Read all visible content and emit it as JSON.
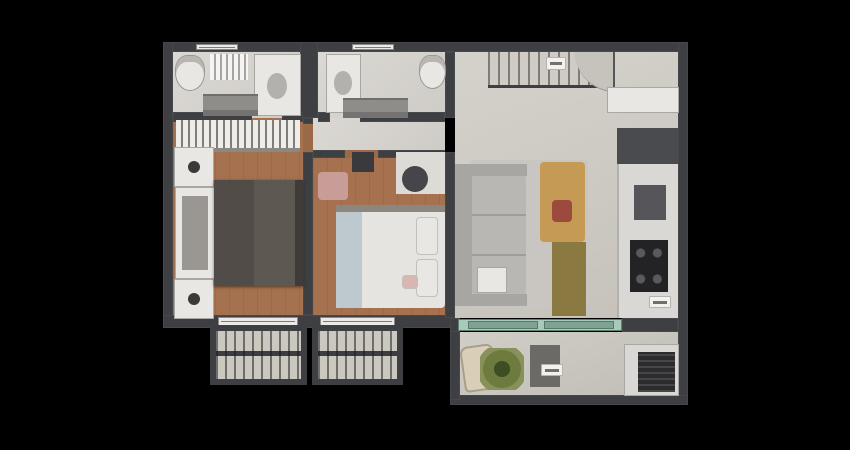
{
  "canvas": {
    "width": 850,
    "height": 450,
    "background": "#000000"
  },
  "plan": {
    "type": "apartment-floor-plan-3d-top-down-render",
    "offset_x": 163,
    "offset_y": 42,
    "width": 525,
    "height": 363,
    "legible_text": [],
    "label_chips": [
      {
        "location": "entry-hall",
        "text": ""
      },
      {
        "location": "kitchen-counter",
        "text": ""
      },
      {
        "location": "balcony",
        "text": ""
      }
    ]
  },
  "palette": {
    "background": "#000000",
    "wall": "#3e3f43",
    "wall_light": "#55565a",
    "wood": "#a5714f",
    "wood_patch": "#9a6948",
    "tile": "#d7d4cf",
    "living_floor": "#d0ccc5",
    "balcony_floor": "#cbc8c0",
    "glass": "#a8cabb",
    "glass_panel": "#7fa392",
    "white": "#e9e7e3",
    "counter": "#dad8d4",
    "shower": "#8f8d8a",
    "wardrobe_base": "#b0ada8",
    "headboard_inner": "#9a9792",
    "bed_dark": "#5d5852",
    "bed_throw": "#514c47",
    "bed_foot": "#3f3b38",
    "sofa": "#b9b7b4",
    "sofa_dark": "#a8a6a3",
    "rug": "#c9c6c1",
    "table_wood": "#c59a55",
    "centerpiece_red": "#9c4a3e",
    "sideboard_wood": "#8a7a42",
    "appliance": "#4a4b4e",
    "stove": "#232325",
    "sink": "#55555a",
    "duvet": "#e6e4e0",
    "sheet_blue": "#bdc9cf",
    "blanket_gray": "#8b8680",
    "pillow_pink": "#d8b7b2",
    "dresser_pink": "#c99d97",
    "desk_white": "#dddbd6",
    "chair_dark": "#46464a",
    "tv_dark": "#3a3a3c",
    "lamp_dark": "#3c3a38",
    "door_leaf": "#c6c3bd",
    "chip_white": "#f2f1ee",
    "window_white": "#eceae6",
    "chaise_beige": "#d9cfb8",
    "side_table": "#6b6a67",
    "grill_dark": "#2c2c2e",
    "plant_green": "#6d7c3e",
    "plant_core": "#3f4d22",
    "sink_oval": "#b3b1ad"
  },
  "rooms": [
    {
      "id": "bathroom-1",
      "name": "bathroom 1",
      "furniture": [
        "vanity",
        "toilet",
        "shower"
      ]
    },
    {
      "id": "bathroom-2",
      "name": "bathroom 2",
      "furniture": [
        "vanity",
        "toilet",
        "shower"
      ]
    },
    {
      "id": "hallway",
      "name": "hallway",
      "furniture": []
    },
    {
      "id": "master-bedroom",
      "name": "master bedroom",
      "furniture": [
        "wardrobe",
        "nightstand",
        "headboard",
        "double bed",
        "nightstand"
      ]
    },
    {
      "id": "bedroom-2",
      "name": "bedroom 2",
      "furniture": [
        "pink dresser",
        "tv stand",
        "desk",
        "desk chair",
        "bed with white duvet"
      ]
    },
    {
      "id": "living-dining",
      "name": "living / dining room",
      "furniture": [
        "l-sofa",
        "rug",
        "coffee table",
        "dining table",
        "centerpiece",
        "sideboard"
      ]
    },
    {
      "id": "entry",
      "name": "entry hall",
      "furniture": [
        "railing screen",
        "entry door",
        "shoe cabinet"
      ]
    },
    {
      "id": "kitchen",
      "name": "kitchen",
      "furniture": [
        "refrigerator",
        "counter",
        "sink",
        "cooktop"
      ]
    },
    {
      "id": "balcony",
      "name": "balcony",
      "furniture": [
        "lounge chair",
        "potted plant",
        "side table",
        "grill counter",
        "barbecue grill"
      ]
    },
    {
      "id": "window-box-1",
      "name": "louvered window box"
    },
    {
      "id": "window-box-2",
      "name": "louvered window box"
    }
  ]
}
